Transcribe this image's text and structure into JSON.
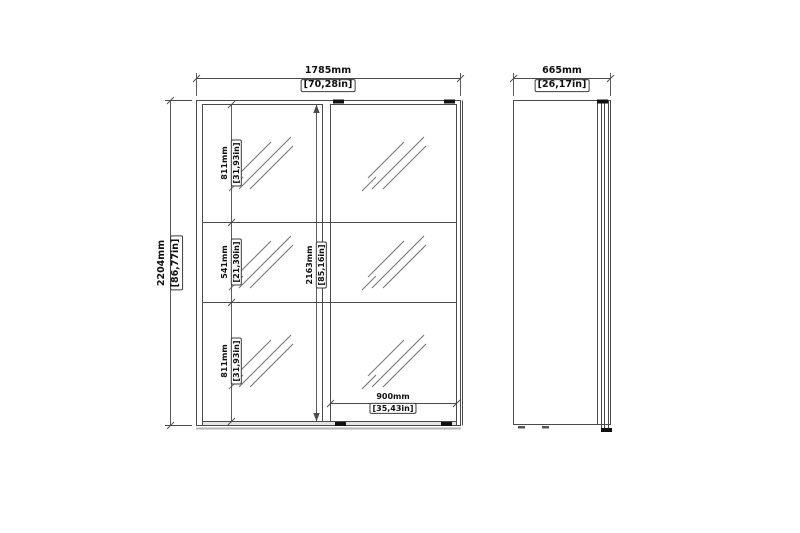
{
  "front_view": {
    "width": {
      "mm": "1785mm",
      "in": "[70,28in]"
    },
    "height": {
      "mm": "2204mm",
      "in": "[86,77in]"
    },
    "door_height": {
      "mm": "2163mm",
      "in": "[85,16in]"
    },
    "top_section": {
      "mm": "811mm",
      "in": "[31,93in]"
    },
    "middle_section": {
      "mm": "541mm",
      "in": "[21,30in]"
    },
    "bottom_section": {
      "mm": "811mm",
      "in": "[31,93in]"
    },
    "door_width": {
      "mm": "900mm",
      "in": "[35,43in]"
    }
  },
  "side_view": {
    "depth": {
      "mm": "665mm",
      "in": "[26,17in]"
    }
  },
  "colors": {
    "line": "#4a4a4a",
    "hatch": "#777777",
    "text": "#111111",
    "background": "#ffffff"
  }
}
